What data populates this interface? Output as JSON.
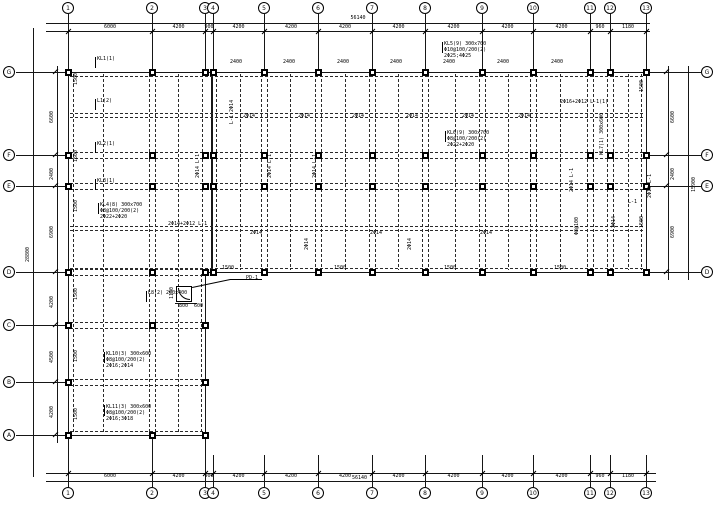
{
  "sheet": {
    "width": 718,
    "height": 508,
    "background": "#ffffff",
    "line_color": "#161616"
  },
  "drawing_type": "structural-beam-layout-plan",
  "grid": {
    "cols": [
      {
        "label": "1",
        "x": 68
      },
      {
        "label": "2",
        "x": 152
      },
      {
        "label": "3",
        "x": 205
      },
      {
        "label": "4",
        "x": 213
      },
      {
        "label": "5",
        "x": 264
      },
      {
        "label": "6",
        "x": 318
      },
      {
        "label": "7",
        "x": 372
      },
      {
        "label": "8",
        "x": 425
      },
      {
        "label": "9",
        "x": 482
      },
      {
        "label": "10",
        "x": 533
      },
      {
        "label": "11",
        "x": 590
      },
      {
        "label": "12",
        "x": 610
      },
      {
        "label": "13",
        "x": 646
      }
    ],
    "rows_left": [
      {
        "label": "G",
        "y": 72
      },
      {
        "label": "F",
        "y": 155
      },
      {
        "label": "E",
        "y": 186
      },
      {
        "label": "D",
        "y": 272
      },
      {
        "label": "C",
        "y": 325
      },
      {
        "label": "B",
        "y": 382
      },
      {
        "label": "A",
        "y": 435
      }
    ],
    "rows_right": [
      "G",
      "F",
      "E",
      "D"
    ]
  },
  "dims": {
    "top": {
      "segments": [
        "6000",
        "4200",
        "900",
        "4200",
        "4200",
        "4200",
        "4200",
        "4200",
        "4200",
        "4200",
        "960",
        "1180"
      ],
      "overall": "56140"
    },
    "bottom": {
      "segments": [
        "6000",
        "4200",
        "900",
        "4200",
        "4200",
        "4200",
        "4200",
        "4200",
        "4200",
        "4200",
        "960",
        "1180"
      ],
      "overall": "56140"
    },
    "left": {
      "segments": [
        "6600",
        "2400",
        "6900",
        "4200",
        "4500",
        "4200"
      ],
      "overall": "28800"
    },
    "right": {
      "segments": [
        "6600",
        "2400",
        "6900"
      ],
      "overall": "15900"
    }
  },
  "plan": {
    "band": {
      "x1": 68,
      "x2": 646,
      "y1": 72,
      "y2": 272
    },
    "wing": {
      "x1": 68,
      "x2": 205,
      "y1": 272,
      "y2": 435
    },
    "joint_x": 211,
    "h_beams_band": [
      76,
      113,
      117,
      152,
      158,
      183,
      189,
      226,
      230,
      268
    ],
    "h_beams_wing": [
      269,
      275,
      322,
      328,
      379,
      385,
      431
    ],
    "v_beams_full": [
      73,
      103,
      149,
      155,
      178
    ],
    "v_beams_band": [
      202,
      216,
      240,
      261,
      267,
      290,
      315,
      321,
      345,
      369,
      375,
      398,
      422,
      428,
      455,
      479,
      485,
      508,
      530,
      536,
      560,
      587,
      593,
      607,
      613,
      628,
      641
    ],
    "v_beams_wing": [
      201
    ],
    "column_rows_full": [
      "G",
      "F",
      "E",
      "D"
    ],
    "wing_columns": [
      {
        "row": "C",
        "cols": [
          68,
          152,
          205
        ]
      },
      {
        "row": "B",
        "cols": [
          68,
          205
        ]
      },
      {
        "row": "A",
        "cols": [
          68,
          152,
          205
        ]
      }
    ],
    "detail": {
      "square": [
        176,
        286,
        16
      ],
      "arc": [
        178,
        288,
        12
      ],
      "leaders": [
        [
          192,
          287,
          230,
          279
        ],
        [
          230,
          279,
          262,
          279
        ]
      ],
      "dim_line": [
        175,
        303,
        22
      ]
    }
  },
  "annotations": [
    [
      97,
      57,
      0,
      "KL1(1)",
      1
    ],
    [
      97,
      99,
      0,
      "L1(2)",
      1
    ],
    [
      97,
      142,
      0,
      "KL2(1)",
      1
    ],
    [
      97,
      179,
      0,
      "KL3(1)",
      1
    ],
    [
      100,
      203,
      0,
      "KL4(8) 300x700",
      1
    ],
    [
      100,
      209,
      0,
      "Φ8@100/200(2)",
      0
    ],
    [
      100,
      215,
      0,
      "2Φ22+2Φ20",
      0
    ],
    [
      106,
      352,
      0,
      "KL10(3) 300x600",
      1
    ],
    [
      106,
      358,
      0,
      "Φ8@100/200(2)",
      0
    ],
    [
      106,
      364,
      0,
      "2Φ16;2Φ14",
      0
    ],
    [
      106,
      405,
      0,
      "KL11(3) 300x600",
      1
    ],
    [
      106,
      411,
      0,
      "Φ8@100/200(2)",
      0
    ],
    [
      106,
      417,
      0,
      "2Φ16;3Φ18",
      0
    ],
    [
      148,
      291,
      0,
      "L8(2) 200x400",
      1
    ],
    [
      444,
      42,
      0,
      "KL5(9) 300x700",
      1
    ],
    [
      444,
      48,
      0,
      "Φ10@100/200(2)",
      0
    ],
    [
      444,
      54,
      0,
      "2Φ25;4Φ25",
      0
    ],
    [
      447,
      131,
      0,
      "KL6(9) 300x700",
      1
    ],
    [
      447,
      137,
      0,
      "Φ8@100/200(2)",
      0
    ],
    [
      447,
      143,
      0,
      "2Φ22+2Φ20",
      0
    ],
    [
      560,
      100,
      0,
      "2Φ16+2Φ12 L-1(1)",
      0
    ],
    [
      168,
      222,
      0,
      "2Φ14+2Φ12 L-1",
      0
    ],
    [
      246,
      276,
      0,
      "PD-1",
      0
    ],
    [
      179,
      304,
      0,
      "800",
      0
    ],
    [
      194,
      304,
      0,
      "600",
      0
    ],
    [
      170,
      299,
      1,
      "1150",
      0
    ],
    [
      196,
      178,
      1,
      "2Φ14 L-1",
      0
    ],
    [
      268,
      178,
      1,
      "2Φ14 L-1",
      0
    ],
    [
      313,
      178,
      1,
      "2Φ14 L-1",
      0
    ],
    [
      570,
      192,
      1,
      "2Φ14 L-1",
      0
    ],
    [
      575,
      235,
      1,
      "Φ8@100",
      0
    ],
    [
      408,
      250,
      1,
      "2Φ14",
      0
    ],
    [
      305,
      250,
      1,
      "2Φ14",
      0
    ],
    [
      230,
      124,
      1,
      "L-1 2Φ14",
      0
    ],
    [
      600,
      155,
      1,
      "KL7(1) 300x600",
      0
    ],
    [
      648,
      198,
      1,
      "2Φ16 L-1",
      0
    ],
    [
      628,
      200,
      0,
      "L-1",
      0
    ],
    [
      612,
      228,
      1,
      "2Φ14",
      0
    ],
    [
      243,
      114,
      0,
      "2Φ14",
      0
    ],
    [
      298,
      114,
      0,
      "2Φ14",
      0
    ],
    [
      352,
      114,
      0,
      "2Φ14",
      0
    ],
    [
      406,
      114,
      0,
      "2Φ14",
      0
    ],
    [
      462,
      114,
      0,
      "2Φ14",
      0
    ],
    [
      518,
      114,
      0,
      "2Φ14",
      0
    ],
    [
      250,
      231,
      0,
      "2Φ14",
      0
    ],
    [
      370,
      231,
      0,
      "2Φ14",
      0
    ],
    [
      480,
      231,
      0,
      "2Φ14",
      0
    ],
    [
      230,
      60,
      0,
      "2400",
      0
    ],
    [
      283,
      60,
      0,
      "2400",
      0
    ],
    [
      337,
      60,
      0,
      "2400",
      0
    ],
    [
      390,
      60,
      0,
      "2400",
      0
    ],
    [
      443,
      60,
      0,
      "2400",
      0
    ],
    [
      497,
      60,
      0,
      "2400",
      0
    ],
    [
      551,
      60,
      0,
      "2400",
      0
    ],
    [
      74,
      85,
      1,
      "1500",
      0
    ],
    [
      74,
      162,
      1,
      "1500",
      0
    ],
    [
      74,
      212,
      1,
      "1500",
      0
    ],
    [
      74,
      300,
      1,
      "1500",
      0
    ],
    [
      74,
      362,
      1,
      "1500",
      0
    ],
    [
      74,
      420,
      1,
      "1500",
      0
    ],
    [
      640,
      92,
      1,
      "1500",
      0
    ],
    [
      640,
      228,
      1,
      "1500",
      0
    ],
    [
      222,
      266,
      0,
      "1500",
      0
    ],
    [
      334,
      266,
      0,
      "1500",
      0
    ],
    [
      444,
      266,
      0,
      "1500",
      0
    ],
    [
      554,
      266,
      0,
      "1500",
      0
    ]
  ]
}
